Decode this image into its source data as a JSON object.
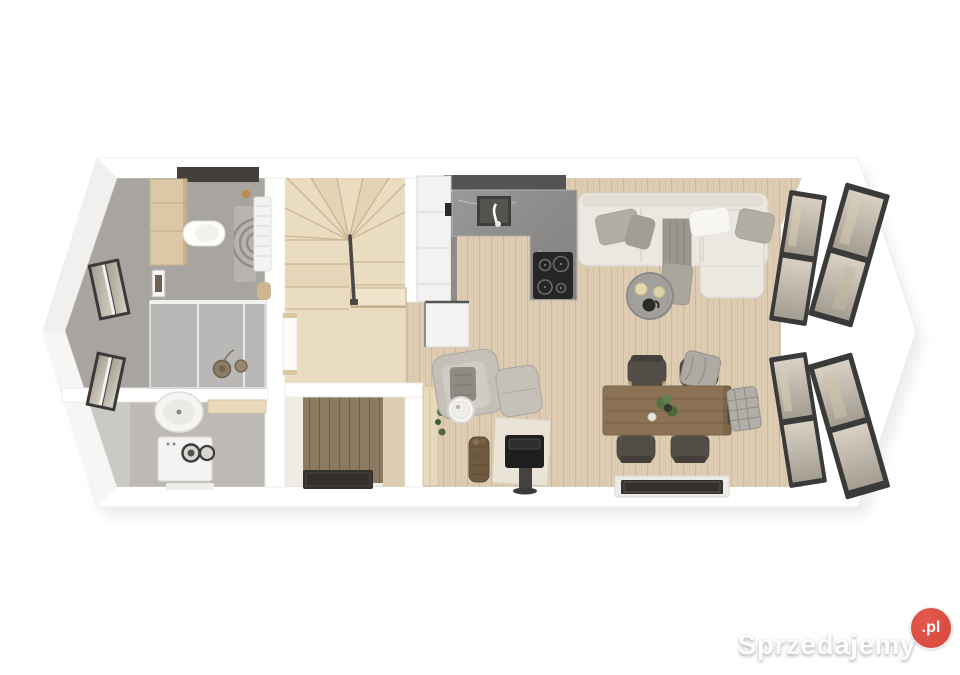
{
  "watermark": {
    "brand": "Sprzedajemy",
    "tld": ".pl"
  },
  "palette": {
    "badge_red": "#d8453b",
    "wall_white": "#ffffff",
    "wood_floor": "#ddccb1",
    "stair_wood": "#eadcc0",
    "tile_gray": "#a8a5a1",
    "utility_gray": "#bdbab6",
    "entry_wood": "#8d7a62",
    "mat_dark": "#34302b",
    "counter_marble": "#8f8d8b",
    "backsplash_dark": "#565452",
    "cabinet_white": "#f3f2f0",
    "cooktop_black": "#262625",
    "sofa_cream": "#ebe8e1",
    "pillow_gray": "#b2aea6",
    "throw_gray": "#9c978e",
    "coffee_table_gray": "#a3a19d",
    "armchair_gray": "#c5c1b9",
    "stove_black": "#1f1f1f",
    "hearth_beige": "#eae4d7",
    "basket_brown": "#6e5a40",
    "table_wood": "#8c7254",
    "chair_dark": "#524d46",
    "plant_green": "#567344",
    "window_frame": "#3a3a3a",
    "glass_beige": "#d7d0c3",
    "glass_gray": "#a49d91",
    "rail_dark": "#4a4845",
    "vanity_wood": "#dcc8a6"
  },
  "floorplan": {
    "rooms": [
      "bathroom",
      "utility-room",
      "staircase",
      "entry-hall",
      "kitchen",
      "living-dining-area"
    ],
    "furniture": [
      "vanity-cabinet",
      "wall-hung-toilet",
      "towel-radiator",
      "bath-rug",
      "shower",
      "round-basin",
      "washing-machine",
      "winder-stairs",
      "kitchen-cabinets",
      "kitchen-sink",
      "induction-cooktop",
      "sectional-sofa",
      "coffee-table",
      "armchair",
      "ottoman",
      "side-table",
      "wood-stove",
      "firewood-basket",
      "dining-table",
      "dining-chairs",
      "doormats",
      "windows"
    ]
  }
}
